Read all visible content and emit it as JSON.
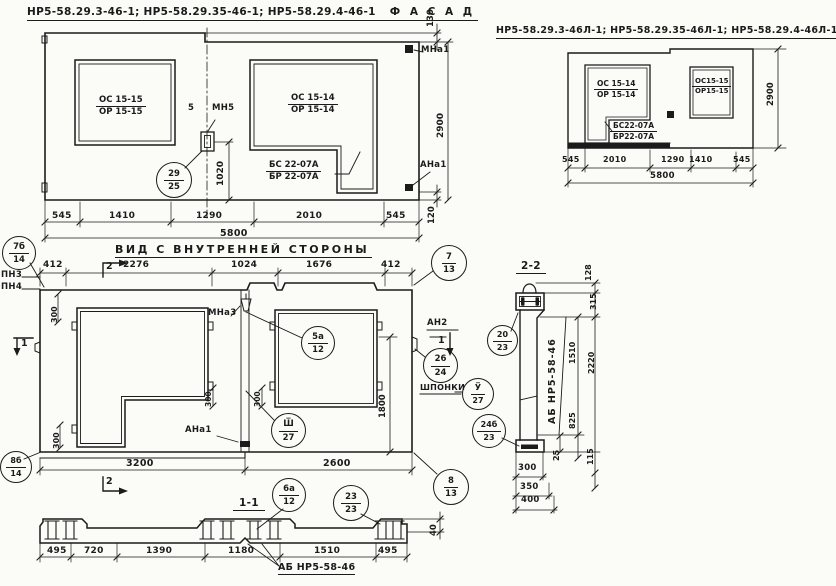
{
  "colors": {
    "ink": "#1b1b1b",
    "paper": "#fbfbf8"
  },
  "facade_main": {
    "title": "НР5-58.29.3-46-1; НР5-58.29.35-46-1; НР5-58.29.4-46-1",
    "view_label": "Ф А С А Д",
    "window_left_top": "ОС 15-15",
    "window_left_bot": "ОР 15-15",
    "window_right_top": "ОС 15-14",
    "window_right_bot": "ОР 15-14",
    "door_top": "БС 22-07А",
    "door_bot": "БР 22-07А",
    "anchor_mid_label": "МН5",
    "anchor_mid_dim": "5",
    "anchor_top_label": "МНа1",
    "anchor_bot_label": "АНа1",
    "dim_v1020": "1020",
    "dim_v130": "130",
    "dim_v2900": "2900",
    "dim_v120": "120",
    "dims_bottom": [
      "545",
      "1410",
      "1290",
      "2010",
      "545"
    ],
    "dim_total": "5800"
  },
  "facade_mirror": {
    "title": "НР5-58.29.3-46Л-1; НР5-58.29.35-46Л-1; НР5-58.29.4-46Л-1",
    "view_label": "Ф А С А Д",
    "window_left_top": "ОС 15-14",
    "window_left_bot": "ОР 15-14",
    "window_right_top": "ОС15-15",
    "window_right_bot": "ОР15-15",
    "door_top": "БС22-07А",
    "door_bot": "БР22-07А",
    "dim_v2900": "2900",
    "dims_bottom": [
      "545",
      "2010",
      "1290",
      "1410",
      "545"
    ],
    "dim_total": "5800"
  },
  "inner_view": {
    "title": "ВИД С ВНУТРЕННЕЙ СТОРОНЫ",
    "dims_top": [
      "412",
      "2276",
      "1024",
      "1676",
      "412"
    ],
    "dims_bottom": [
      "3200",
      "2600"
    ],
    "dim_v1800": "1800",
    "dim_300a": "300",
    "dim_300b": "300",
    "dim_300c": "300",
    "dim_300d": "300",
    "label_pn3": "ПН3",
    "label_pn4": "ПН4",
    "label_mna3": "МНа3",
    "label_ana1": "АНа1",
    "label_an2": "АН2",
    "label_shponki": "ШПОНКИ",
    "mark_1_left": "1",
    "mark_1_right": "1",
    "mark_2_top": "2",
    "mark_2_bottom": "2"
  },
  "balloons": {
    "b29_25": {
      "top": "29",
      "bot": "25"
    },
    "b7b_14": {
      "top": "7б",
      "bot": "14"
    },
    "b7_13": {
      "top": "7",
      "bot": "13"
    },
    "b8b_14": {
      "top": "8б",
      "bot": "14"
    },
    "b8_13": {
      "top": "8",
      "bot": "13"
    },
    "b5a_12": {
      "top": "5а",
      "bot": "12"
    },
    "bsh_27": {
      "top": "Ш̅",
      "bot": "27"
    },
    "b6a_12": {
      "top": "6а",
      "bot": "12"
    },
    "b23_23": {
      "top": "23",
      "bot": "23"
    },
    "b26_24": {
      "top": "26",
      "bot": "24"
    },
    "bu_27": {
      "top": "У̅",
      "bot": "27"
    },
    "b24b_23": {
      "top": "24б",
      "bot": "23"
    },
    "b20_23": {
      "top": "20",
      "bot": "23"
    }
  },
  "section_1_1": {
    "title": "1-1",
    "dims_bottom": [
      "495",
      "720",
      "1390",
      "1180",
      "1510",
      "495"
    ],
    "dim_v40": "40",
    "label_ab": "АБ НР5-58-46"
  },
  "section_2_2": {
    "title": "2-2",
    "label_ab": "АБ НР5-58-46",
    "dim_v128": "128",
    "dim_v315": "315",
    "dim_v1510": "1510",
    "dim_v2220": "2220",
    "dim_v825": "825",
    "dim_v25": "25",
    "dim_v115": "115",
    "dims_width": [
      "300",
      "350",
      "400"
    ]
  }
}
